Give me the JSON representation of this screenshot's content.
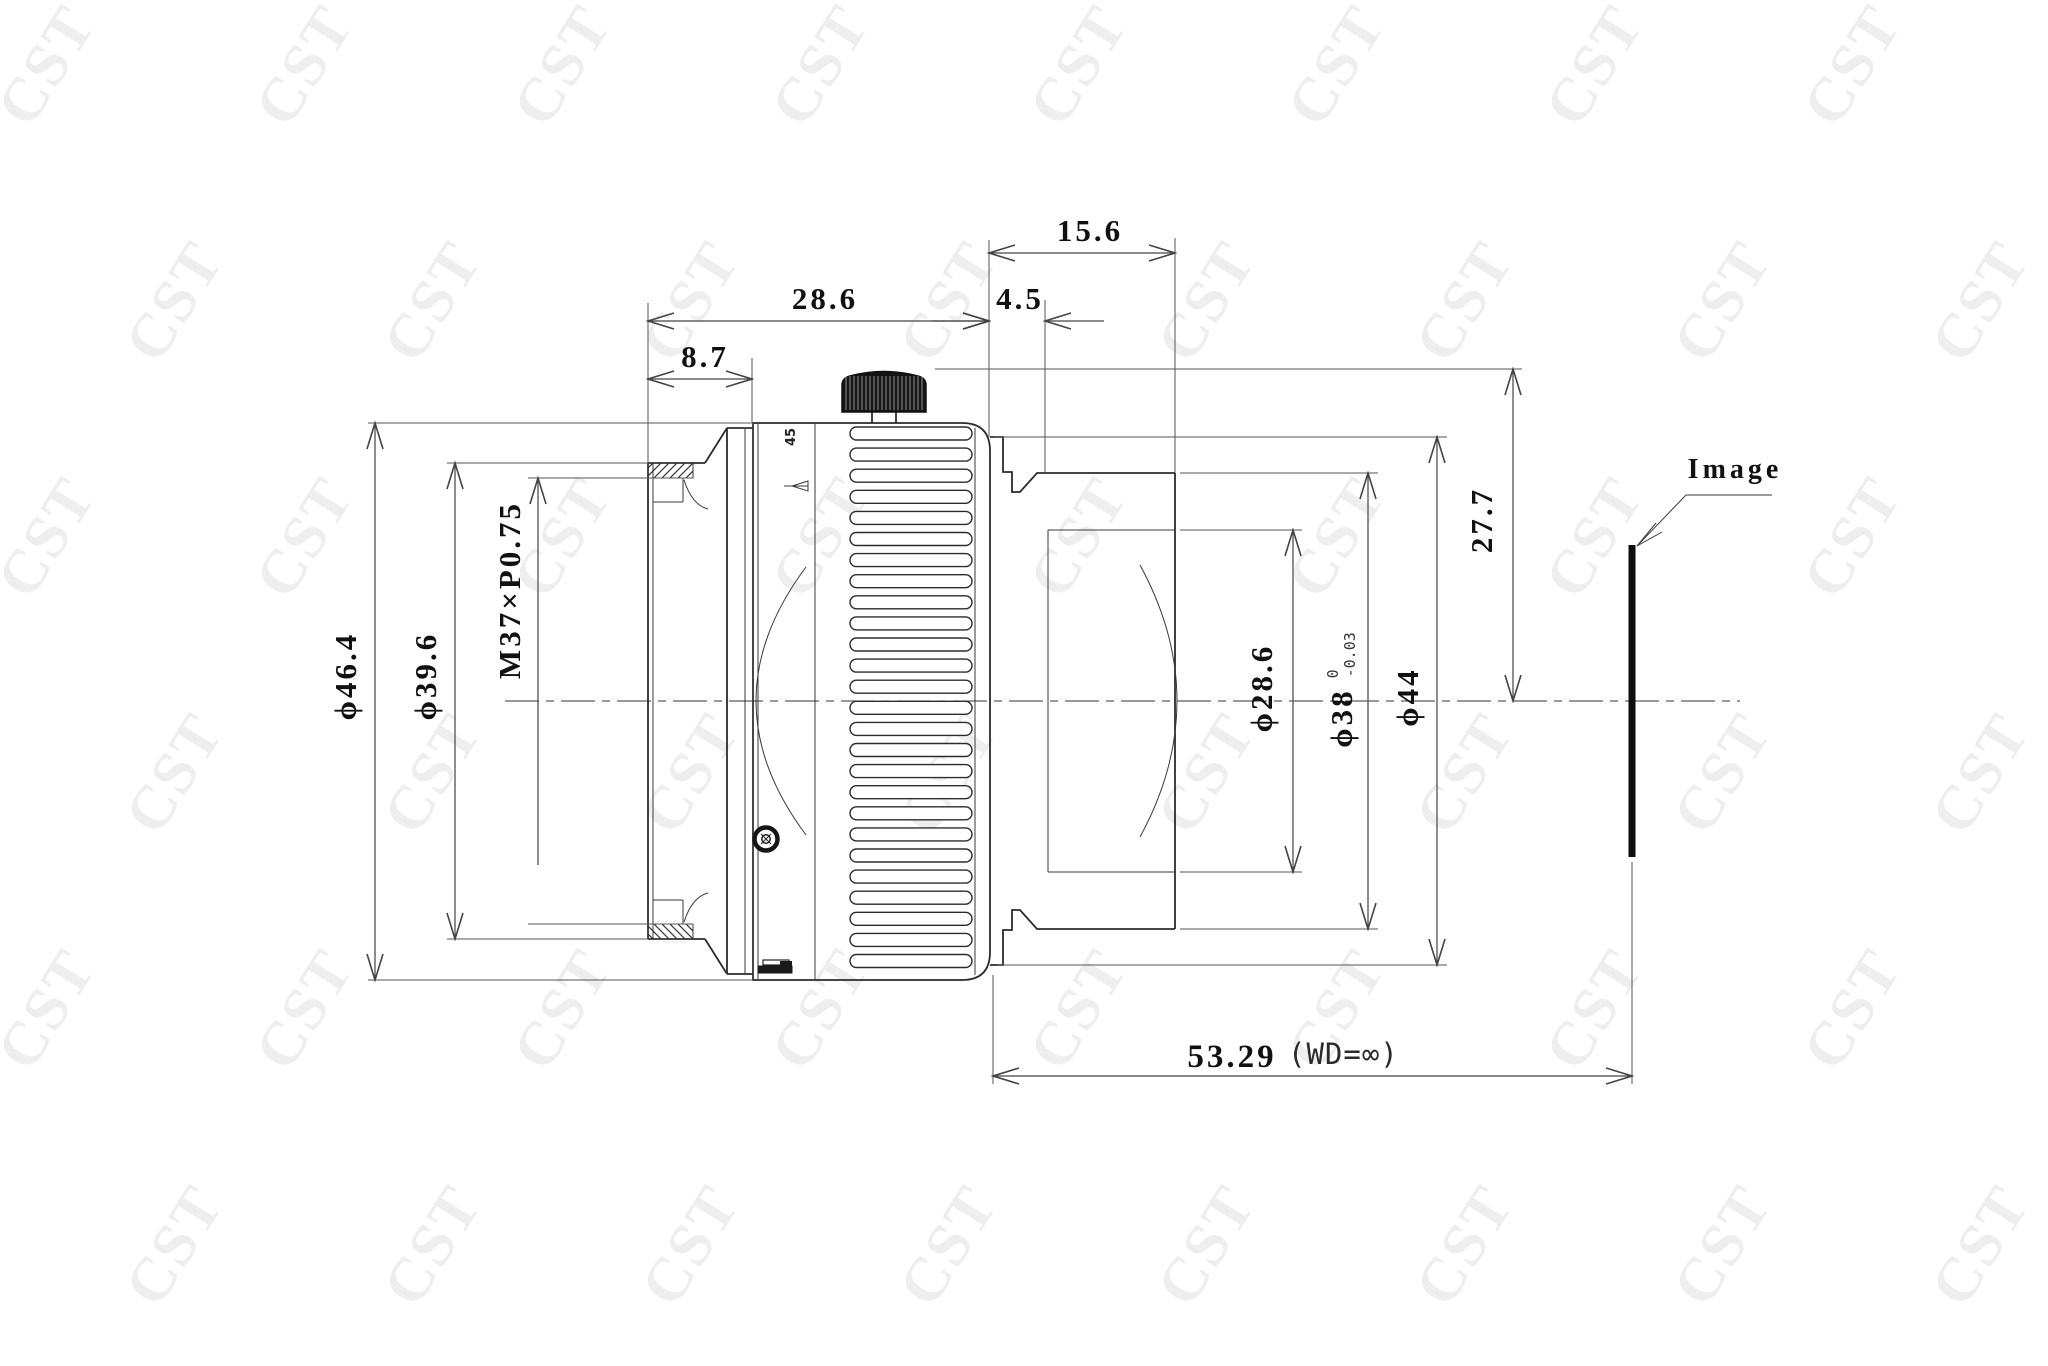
{
  "drawing": {
    "watermark": "CST",
    "labels": {
      "image_plane": "Image",
      "focus_index": "45"
    },
    "dimensions": {
      "lens_to_ring_rear": "28.6",
      "front_ring_width": "8.7",
      "rear_section_length": "15.6",
      "collar_width": "4.5",
      "front_outer_dia": "ϕ46.4",
      "front_tube_dia": "ϕ39.6",
      "filter_thread": "M37×P0.75",
      "rear_aperture_dia": "ϕ28.6",
      "mount_dia": "ϕ38",
      "mount_dia_tol_upper": "0",
      "mount_dia_tol_lower": "-0.03",
      "rear_flange_dia": "ϕ44",
      "max_radius_height": "27.7",
      "flange_to_image": "53.29",
      "working_distance": "(WD=∞)"
    }
  }
}
